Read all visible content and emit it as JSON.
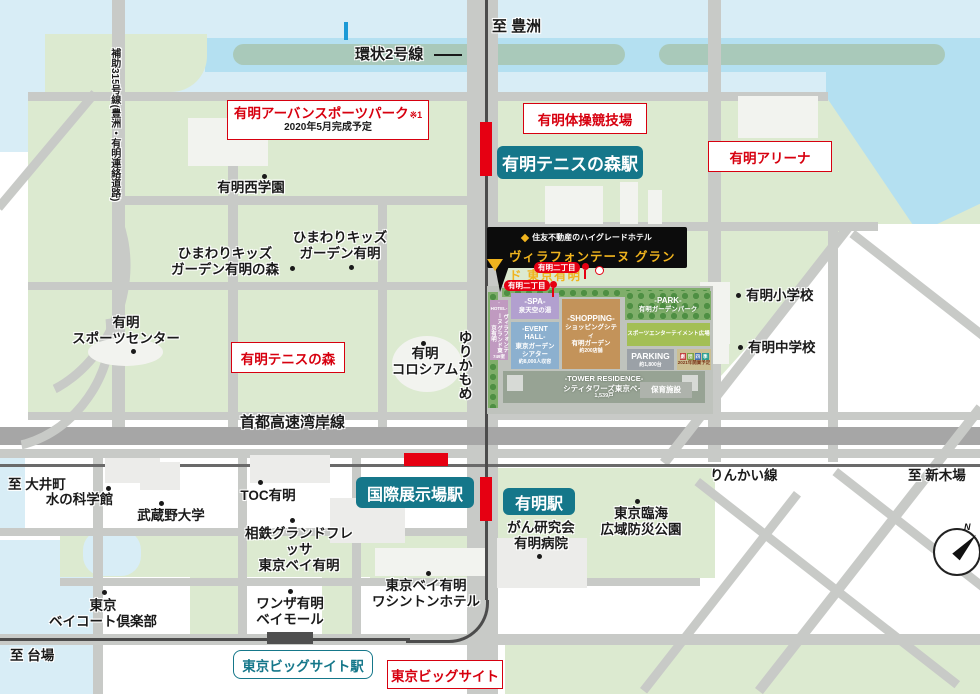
{
  "map": {
    "directions": {
      "toyosu": "至 豊洲",
      "oimachi": "至 大井町",
      "shinkiba": "至 新木場",
      "daiba": "至 台場"
    },
    "lines": {
      "kanjo2": "環状2号線",
      "hojo315": "補助315号線(豊洲・有明連絡道路)",
      "yurikamome": "ゆりかもめ",
      "wangan": "首都高速湾岸線",
      "rinkai": "りんかい線"
    },
    "stations": {
      "tennis_no_mori": "有明テニスの森駅",
      "kokusai_tenjijo": "国際展示場駅",
      "ariake": "有明駅",
      "big_sight": "東京ビッグサイト駅"
    },
    "facilities": {
      "urban_sports_park": {
        "title": "有明アーバンスポーツパーク",
        "note": "※1",
        "sub": "2020年5月完成予定"
      },
      "gymnastics": "有明体操競技場",
      "arena": "有明アリーナ",
      "tennis_forest": "有明テニスの森",
      "big_sight": "東京ビッグサイト"
    },
    "pois": [
      {
        "text": "有明西学園"
      },
      {
        "text": "ひまわりキッズ\nガーデン有明の森"
      },
      {
        "text": "ひまわりキッズ\nガーデン有明"
      },
      {
        "text": "有明\nスポーツセンター"
      },
      {
        "text": "有明\nコロシアム"
      },
      {
        "text": "有明小学校"
      },
      {
        "text": "有明中学校"
      },
      {
        "text": "水の科学館"
      },
      {
        "text": "武蔵野大学"
      },
      {
        "text": "TOC有明"
      },
      {
        "text": "相鉄グランドフレッサ\n東京ベイ有明"
      },
      {
        "text": "がん研究会\n有明病院"
      },
      {
        "text": "東京臨海\n広域防災公園"
      },
      {
        "text": "東京\nベイコート倶楽部"
      },
      {
        "text": "ワンザ有明\nベイモール"
      },
      {
        "text": "東京ベイ有明\nワシントンホテル"
      }
    ],
    "callout": {
      "tagline": "住友不動産のハイグレードホテル",
      "name": "ヴィラフォンテーヌ グランド 東京有明"
    },
    "bus_stop": {
      "label": "有明二丁目"
    },
    "site": {
      "hotel": {
        "tag": "-HOTEL-",
        "name": "ヴィラフォンテーヌ グランド東京有明",
        "rooms": "749室"
      },
      "spa": {
        "tag": "-SPA-",
        "name": "泉天空の湯"
      },
      "event_hall": {
        "tag": "-EVENT HALL-",
        "name": "東京ガーデン\nシアター",
        "capacity": "約8,000人収容"
      },
      "shopping": {
        "tag": "-SHOPPING-",
        "name": "ショッピングシティ\n有明ガーデン",
        "shops": "約200店舗"
      },
      "park": {
        "tag": "-PARK-",
        "name": "有明ガーデンパーク"
      },
      "sports_plaza": {
        "name": "スポーツエンターテイメント広場"
      },
      "parking": {
        "tag": "PARKING",
        "capacity": "約1,800台"
      },
      "theater": {
        "tiles": [
          "劇",
          "団",
          "四",
          "季"
        ],
        "note": "2021年開業予定"
      },
      "tower": {
        "tag": "-TOWER RESIDENCE-",
        "name": "シティタワーズ東京ベイ",
        "units": "1,539戸"
      },
      "nursery": {
        "name": "保育施設"
      }
    },
    "compass": {
      "n": "N"
    },
    "colors": {
      "accent_red": "#d7000f",
      "marker_red": "#e60012",
      "station_teal": "#15778a",
      "gold": "#f0b41e",
      "land_green": "#dcead0",
      "water_blue": "#d8edf6"
    }
  }
}
